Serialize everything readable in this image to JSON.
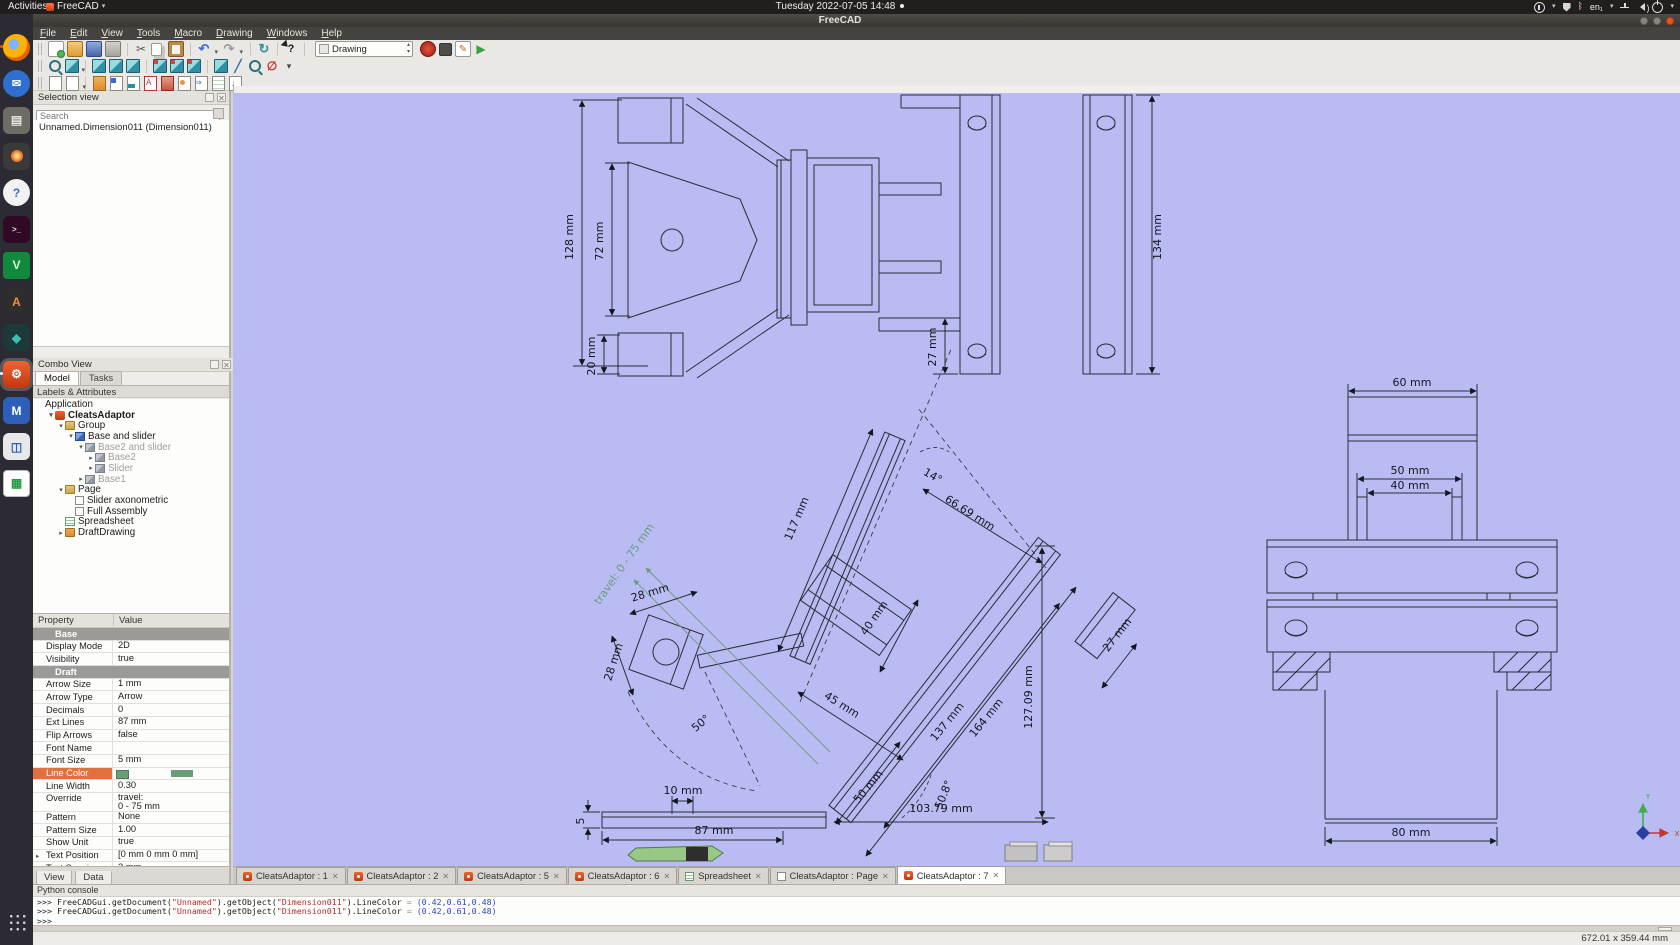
{
  "topbar": {
    "activities": "Activities",
    "app_name": "FreeCAD",
    "clock": "Tuesday 2022-07-05 14:48",
    "keyboard_layout": "en₁"
  },
  "window": {
    "title": "FreeCAD"
  },
  "menubar": [
    "File",
    "Edit",
    "View",
    "Tools",
    "Macro",
    "Drawing",
    "Windows",
    "Help"
  ],
  "toolbar": {
    "workbench_selector": "Drawing",
    "row1": [
      "new-document",
      "open-document",
      "save-document",
      "print",
      "cut",
      "copy",
      "paste",
      "undo",
      "redo",
      "refresh",
      "whats-this",
      "workbench-selector",
      "macro-record",
      "macro-stop",
      "macro-edit",
      "macro-play"
    ],
    "row2": [
      "fit-all",
      "draw-style",
      "axonometric-view",
      "front-view",
      "top-view",
      "right-view",
      "rear-view",
      "bottom-view",
      "left-view",
      "measure-distance",
      "zoom-selection",
      "clipping-plane",
      "view-more"
    ],
    "row3": [
      "new-page",
      "page-template",
      "open-svg",
      "insert-view",
      "insert-draft-view",
      "insert-annotation",
      "insert-clip-group",
      "insert-symbol",
      "draft-to-sheet",
      "spreadsheet-view",
      "export-page"
    ]
  },
  "selection_view": {
    "title": "Selection view",
    "search_placeholder": "Search",
    "items": [
      "Unnamed.Dimension011 (Dimension011)"
    ]
  },
  "combo_view": {
    "title": "Combo View",
    "tabs": [
      {
        "label": "Model",
        "active": true
      },
      {
        "label": "Tasks",
        "active": false
      }
    ],
    "header": "Labels & Attributes",
    "tree": [
      {
        "label": "Application",
        "depth": 0
      },
      {
        "label": "CleatsAdaptor",
        "depth": 1,
        "icon": "freecad-doc",
        "arrow": "down",
        "bold": true
      },
      {
        "label": "Group",
        "depth": 2,
        "icon": "folder",
        "arrow": "down"
      },
      {
        "label": "Base and slider",
        "depth": 3,
        "icon": "part",
        "arrow": "down"
      },
      {
        "label": "Base2 and slider",
        "depth": 4,
        "icon": "part-gray",
        "arrow": "down",
        "muted": true
      },
      {
        "label": "Base2",
        "depth": 5,
        "icon": "part-gray",
        "arrow": "right",
        "muted": true
      },
      {
        "label": "Slider",
        "depth": 5,
        "icon": "part-gray",
        "arrow": "right",
        "muted": true
      },
      {
        "label": "Base1",
        "depth": 4,
        "icon": "part-gray",
        "arrow": "right",
        "muted": true
      },
      {
        "label": "Page",
        "depth": 2,
        "icon": "folder",
        "arrow": "down"
      },
      {
        "label": "Slider axonometric",
        "depth": 3,
        "icon": "checkbox"
      },
      {
        "label": "Full Assembly",
        "depth": 3,
        "icon": "checkbox"
      },
      {
        "label": "Spreadsheet",
        "depth": 2,
        "icon": "spreadsheet"
      },
      {
        "label": "DraftDrawing",
        "depth": 2,
        "icon": "folder-orange",
        "arrow": "right"
      }
    ]
  },
  "properties": {
    "columns": [
      "Property",
      "Value"
    ],
    "rows": [
      {
        "name": "Base",
        "group": true
      },
      {
        "name": "Display Mode",
        "value": "2D"
      },
      {
        "name": "Visibility",
        "value": "true"
      },
      {
        "name": "Draft",
        "group": true
      },
      {
        "name": "Arrow Size",
        "value": "1 mm"
      },
      {
        "name": "Arrow Type",
        "value": "Arrow"
      },
      {
        "name": "Decimals",
        "value": "0"
      },
      {
        "name": "Ext Lines",
        "value": "87 mm"
      },
      {
        "name": "Flip Arrows",
        "value": "false"
      },
      {
        "name": "Font Name",
        "value": ""
      },
      {
        "name": "Font Size",
        "value": "5 mm"
      },
      {
        "name": "Line Color",
        "value": "",
        "selected": true,
        "swatch": "#6b9c7a"
      },
      {
        "name": "Line Width",
        "value": "0.30"
      },
      {
        "name": "Override",
        "value": "travel:\n0 - 75 mm",
        "tall": true
      },
      {
        "name": "Pattern",
        "value": "None"
      },
      {
        "name": "Pattern Size",
        "value": "1.00"
      },
      {
        "name": "Show Unit",
        "value": "true"
      },
      {
        "name": "Text Position",
        "value": "[0 mm  0 mm  0 mm]",
        "expander": true
      },
      {
        "name": "Text Spacing",
        "value": "3 mm"
      }
    ],
    "bottom_tabs": [
      "View",
      "Data"
    ]
  },
  "document_tabs": [
    {
      "label": "CleatsAdaptor : 1",
      "icon": "freecad"
    },
    {
      "label": "CleatsAdaptor : 2",
      "icon": "freecad"
    },
    {
      "label": "CleatsAdaptor : 5",
      "icon": "freecad"
    },
    {
      "label": "CleatsAdaptor : 6",
      "icon": "freecad"
    },
    {
      "label": "Spreadsheet",
      "icon": "spreadsheet"
    },
    {
      "label": "CleatsAdaptor : Page",
      "icon": "page"
    },
    {
      "label": "CleatsAdaptor : 7",
      "icon": "freecad",
      "active": true
    }
  ],
  "python_console": {
    "title": "Python console",
    "lines": [
      [
        {
          "t": ">>> FreeCADGui.getDocument(",
          "c": "k"
        },
        {
          "t": "\"Unnamed\"",
          "c": "s"
        },
        {
          "t": ").getObject(",
          "c": "k"
        },
        {
          "t": "\"Dimension011\"",
          "c": "s"
        },
        {
          "t": ").LineColor ",
          "c": "k"
        },
        {
          "t": "= ",
          "c": "d"
        },
        {
          "t": "(0.42,0.61,0.48)",
          "c": "n"
        }
      ],
      [
        {
          "t": ">>> FreeCADGui.getDocument(",
          "c": "k"
        },
        {
          "t": "\"Unnamed\"",
          "c": "s"
        },
        {
          "t": ").getObject(",
          "c": "k"
        },
        {
          "t": "\"Dimension011\"",
          "c": "s"
        },
        {
          "t": ").LineColor ",
          "c": "k"
        },
        {
          "t": "= ",
          "c": "d"
        },
        {
          "t": "(0.42,0.61,0.48)",
          "c": "n"
        }
      ],
      [
        {
          "t": ">>>",
          "c": "k"
        }
      ]
    ]
  },
  "status_bar": {
    "page_size": "672.01 x 359.44 mm"
  },
  "dock": [
    "firefox",
    "thunderbird",
    "files",
    "photos",
    "help",
    "terminal",
    "vim",
    "app-a",
    "app-teal",
    "freecad",
    "app-m",
    "boxes",
    "libreoffice-calc"
  ],
  "dock_active": "freecad",
  "drawing": {
    "background": "#b8bcf3",
    "line_color": "#2b2b33",
    "dimension_color": "#16161e",
    "travel_color": "#6b9c7a",
    "labels": [
      {
        "t": "128 mm",
        "x": 573,
        "y": 237,
        "r": -90
      },
      {
        "t": "72 mm",
        "x": 603,
        "y": 241,
        "r": -90
      },
      {
        "t": "20 mm",
        "x": 595,
        "y": 356,
        "r": -90
      },
      {
        "t": "27 mm",
        "x": 936,
        "y": 347,
        "r": -90
      },
      {
        "t": "134 mm",
        "x": 1161,
        "y": 237,
        "r": -90
      },
      {
        "t": "60 mm",
        "x": 1412,
        "y": 386,
        "r": 0
      },
      {
        "t": "50 mm",
        "x": 1410,
        "y": 474,
        "r": 0
      },
      {
        "t": "40 mm",
        "x": 1410,
        "y": 489,
        "r": 0
      },
      {
        "t": "80 mm",
        "x": 1411,
        "y": 836,
        "r": 0
      },
      {
        "t": "117 mm",
        "x": 800,
        "y": 520,
        "r": -67
      },
      {
        "t": "14°",
        "x": 931,
        "y": 479,
        "r": 30
      },
      {
        "t": "66.69 mm",
        "x": 968,
        "y": 516,
        "r": 32
      },
      {
        "t": "travel: 0 - 75 mm",
        "x": 627,
        "y": 566,
        "r": -55,
        "c": "g"
      },
      {
        "t": "28 mm",
        "x": 651,
        "y": 596,
        "r": -17
      },
      {
        "t": "28 mm",
        "x": 617,
        "y": 663,
        "r": -72
      },
      {
        "t": "40 mm",
        "x": 877,
        "y": 620,
        "r": -55
      },
      {
        "t": "45 mm",
        "x": 840,
        "y": 708,
        "r": 32
      },
      {
        "t": "50°",
        "x": 703,
        "y": 726,
        "r": -40
      },
      {
        "t": "27 mm",
        "x": 1120,
        "y": 637,
        "r": -52
      },
      {
        "t": "137 mm",
        "x": 950,
        "y": 724,
        "r": -51
      },
      {
        "t": "164 mm",
        "x": 989,
        "y": 720,
        "r": -51
      },
      {
        "t": "127.09 mm",
        "x": 1032,
        "y": 697,
        "r": -90
      },
      {
        "t": "50 mm",
        "x": 871,
        "y": 789,
        "r": -50
      },
      {
        "t": "50.8°",
        "x": 947,
        "y": 796,
        "r": -68
      },
      {
        "t": "103.79 mm",
        "x": 941,
        "y": 812,
        "r": 0
      },
      {
        "t": "10 mm",
        "x": 683,
        "y": 794,
        "r": 0
      },
      {
        "t": "87 mm",
        "x": 714,
        "y": 834,
        "r": 0
      },
      {
        "t": "5",
        "x": 584,
        "y": 821,
        "r": -90
      },
      {
        "t": "Y",
        "x": 1648,
        "y": 799,
        "r": 0,
        "c": "ay"
      },
      {
        "t": "X",
        "x": 1677,
        "y": 836,
        "r": 0,
        "c": "ax"
      }
    ]
  }
}
